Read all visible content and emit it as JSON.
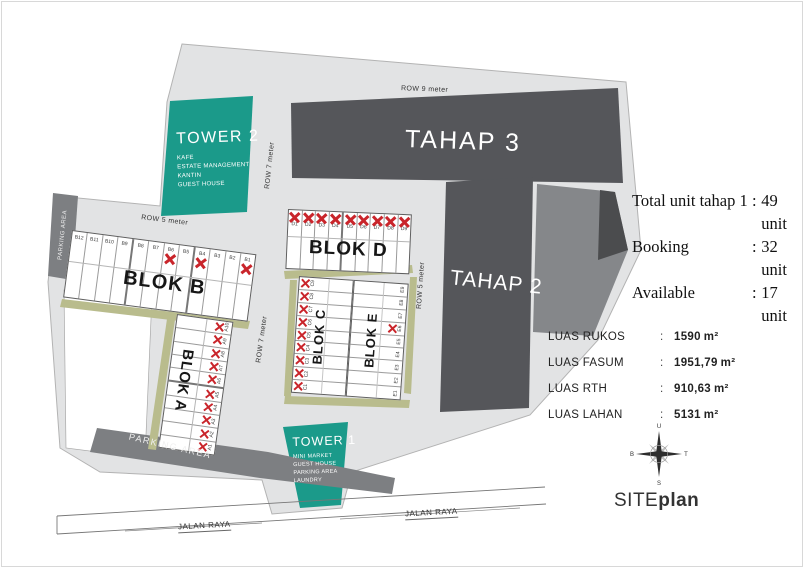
{
  "site": {
    "row9_label": "ROW 9 meter",
    "row7_label": "ROW 7 meter",
    "row5_label": "ROW 5 meter",
    "jalan_label": "JALAN RAYA",
    "parking_label": "PARKING AREA"
  },
  "tahaps": {
    "tahap3": "TAHAP 3",
    "tahap2": "TAHAP 2"
  },
  "towers": {
    "tower2": {
      "title": "TOWER 2",
      "facilities": [
        "KAFE",
        "ESTATE MANAGEMENT",
        "KANTIN",
        "GUEST HOUSE"
      ]
    },
    "tower1": {
      "title": "TOWER 1",
      "facilities": [
        "MINI MARKET",
        "GUEST HOUSE",
        "PARKING AREA",
        "LAUNDRY"
      ]
    }
  },
  "stats": {
    "items": [
      {
        "label": "Total unit tahap 1",
        "value": "49 unit"
      },
      {
        "label": "Booking",
        "value": "32 unit"
      },
      {
        "label": "Available",
        "value": "17 unit"
      }
    ]
  },
  "luas": {
    "items": [
      {
        "label": "LUAS RUKOS",
        "value": "1590",
        "unit": "m²"
      },
      {
        "label": "LUAS FASUM",
        "value": "1951,79",
        "unit": "m²"
      },
      {
        "label": "LUAS RTH",
        "value": "910,63",
        "unit": "m²"
      },
      {
        "label": "LUAS LAHAN",
        "value": "5131",
        "unit": "m²"
      }
    ]
  },
  "blocks": [
    {
      "id": "b",
      "title": "BLOK B",
      "units": [
        {
          "label": "B12",
          "sold": false
        },
        {
          "label": "B11",
          "sold": false
        },
        {
          "label": "B10",
          "sold": false
        },
        {
          "label": "B9",
          "sold": false
        },
        {
          "label": "B8",
          "sold": false
        },
        {
          "label": "B7",
          "sold": false
        },
        {
          "label": "B6",
          "sold": true
        },
        {
          "label": "B5",
          "sold": false
        },
        {
          "label": "B4",
          "sold": true
        },
        {
          "label": "B3",
          "sold": false
        },
        {
          "label": "B2",
          "sold": false
        },
        {
          "label": "B1",
          "sold": true
        }
      ]
    },
    {
      "id": "d",
      "title": "BLOK D",
      "units": [
        {
          "label": "D1",
          "sold": true
        },
        {
          "label": "D2",
          "sold": true
        },
        {
          "label": "D3",
          "sold": true
        },
        {
          "label": "D4",
          "sold": true
        },
        {
          "label": "D5",
          "sold": true
        },
        {
          "label": "D6",
          "sold": true
        },
        {
          "label": "D7",
          "sold": true
        },
        {
          "label": "D8",
          "sold": true
        },
        {
          "label": "D9",
          "sold": true
        }
      ]
    },
    {
      "id": "a",
      "title": "BLOK A",
      "units": [
        {
          "label": "A10",
          "sold": true
        },
        {
          "label": "A9",
          "sold": true
        },
        {
          "label": "A8",
          "sold": true
        },
        {
          "label": "A7",
          "sold": true
        },
        {
          "label": "A6",
          "sold": true
        },
        {
          "label": "A5",
          "sold": true
        },
        {
          "label": "A4",
          "sold": true
        },
        {
          "label": "A3",
          "sold": true
        },
        {
          "label": "A2",
          "sold": true
        },
        {
          "label": "A1",
          "sold": true
        }
      ]
    },
    {
      "id": "c",
      "title": "BLOK C",
      "units": [
        {
          "label": "C9",
          "sold": true
        },
        {
          "label": "C8",
          "sold": true
        },
        {
          "label": "C7",
          "sold": true
        },
        {
          "label": "C6",
          "sold": true
        },
        {
          "label": "C5",
          "sold": true
        },
        {
          "label": "C4",
          "sold": true
        },
        {
          "label": "C3",
          "sold": true
        },
        {
          "label": "C2",
          "sold": true
        },
        {
          "label": "C1",
          "sold": true
        }
      ]
    },
    {
      "id": "e",
      "title": "BLOK E",
      "units": [
        {
          "label": "E9",
          "sold": false
        },
        {
          "label": "E8",
          "sold": false
        },
        {
          "label": "E7",
          "sold": false
        },
        {
          "label": "E6",
          "sold": true
        },
        {
          "label": "E5",
          "sold": false
        },
        {
          "label": "E4",
          "sold": false
        },
        {
          "label": "E3",
          "sold": false
        },
        {
          "label": "E2",
          "sold": false
        },
        {
          "label": "E1",
          "sold": false
        }
      ]
    }
  ],
  "compass": {
    "north": "U",
    "east": "T",
    "south": "S",
    "west": "B"
  },
  "branding": {
    "title_part1": "SITE",
    "title_part2": "plan"
  },
  "colors": {
    "teal": "#1b9a8a",
    "dark_grey": "#55565a",
    "mid_grey": "#85878a",
    "band_grey": "#7d7f82",
    "ground_grey": "#e2e3e4",
    "olive": "#b9bc8d",
    "sold_x": "#c9252b"
  }
}
